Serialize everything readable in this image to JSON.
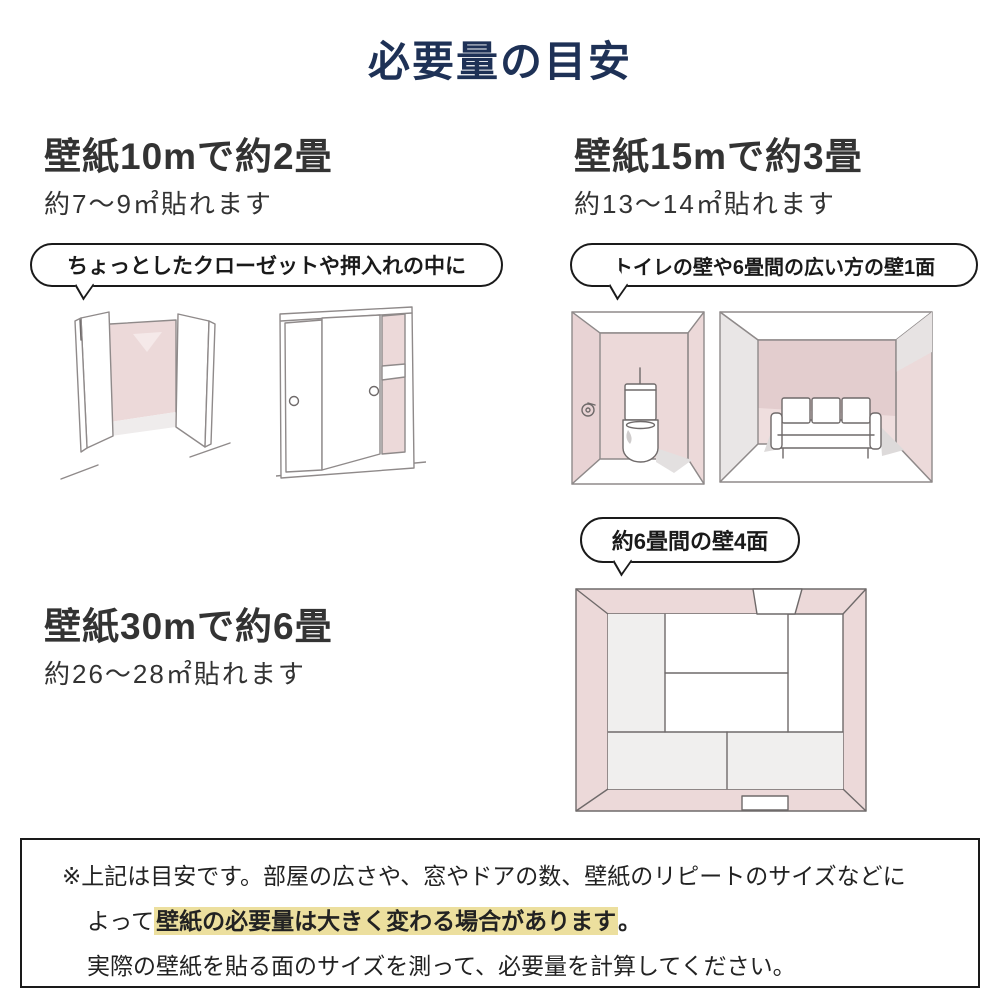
{
  "title": "必要量の目安",
  "colors": {
    "title_navy": "#1e3156",
    "heading_text": "#333333",
    "wall_pink": "#ecd9d9",
    "wall_pink_dark": "#e3cdce",
    "wall_pink_light": "#f5e9e9",
    "wall_gray": "#e9e6e6",
    "shadow_gray": "#e3e0e0",
    "highlight_yellow": "#ecdf9e",
    "line_color": "#1a1a1a"
  },
  "sections": [
    {
      "heading": "壁紙10mで約2畳",
      "subheading": "約7〜9㎡貼れます",
      "bubble": "ちょっとしたクローゼットや押入れの中に",
      "illustrations": [
        "closet-open-doors",
        "oshiire-sliding-closet"
      ]
    },
    {
      "heading": "壁紙15mで約3畳",
      "subheading": "約13〜14㎡貼れます",
      "bubble": "トイレの壁や6畳間の広い方の壁1面",
      "illustrations": [
        "toilet-room",
        "sofa-room-one-wall"
      ]
    },
    {
      "heading": "壁紙30mで約6畳",
      "subheading": "約26〜28㎡貼れます",
      "bubble": "約6畳間の壁4面",
      "illustrations": [
        "tatami-room-top-view"
      ]
    }
  ],
  "note": {
    "line1": "※上記は目安です。部屋の広さや、窓やドアの数、壁紙のリピートのサイズなどに",
    "line2_prefix": "よって",
    "line2_highlight": "壁紙の必要量は大きく変わる場合があります",
    "line2_suffix": "。",
    "line3": "実際の壁紙を貼る面のサイズを測って、必要量を計算してください。"
  }
}
